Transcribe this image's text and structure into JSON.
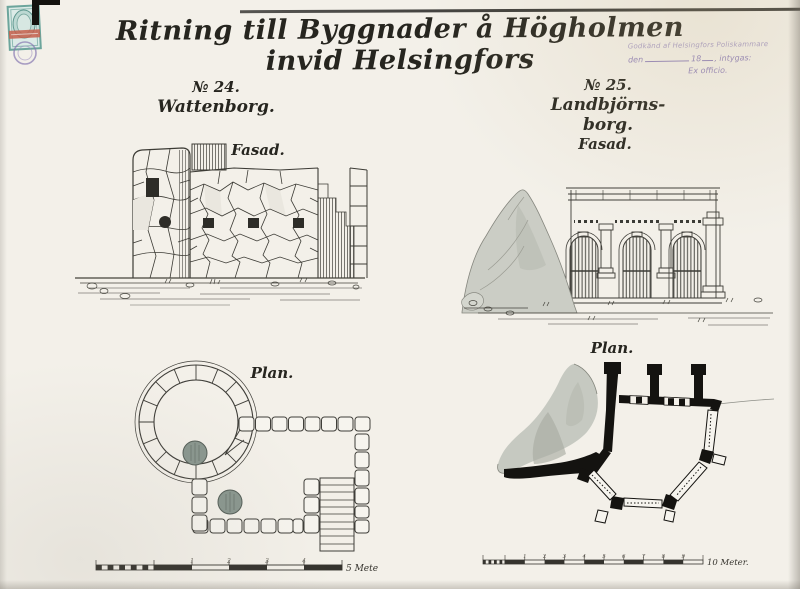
{
  "document": {
    "title": "Ritning till Byggnader å Högholmen invid Helsingfors",
    "approval_stamp": {
      "line1": "Godkänd af Helsingfors Poliskammare",
      "line2_den": "den",
      "line2_year": "18",
      "line2_intygas": ", intygas:",
      "line3": "Ex officio."
    },
    "left_section": {
      "number": "№ 24.",
      "name": "Wattenborg.",
      "fasad_label": "Fasad.",
      "plan_label": "Plan.",
      "scale": {
        "ticks": [
          "1",
          "2",
          "3",
          "4"
        ],
        "unit_label": "5 Meter."
      }
    },
    "right_section": {
      "number": "№ 25.",
      "name": "Landbjörns-borg.",
      "fasad_label": "Fasad.",
      "plan_label": "Plan.",
      "scale": {
        "ticks": [
          "1",
          "2",
          "3",
          "4",
          "5",
          "6",
          "7",
          "8",
          "9"
        ],
        "unit_label": "10 Meter."
      }
    }
  },
  "colors": {
    "paper": "#f3f0e9",
    "ink": "#26251f",
    "approval_purple": "#8b7cb8",
    "stamp_teal": "#6ca59c",
    "stamp_red": "#c75f4b",
    "rock_gray": "#c6c9c1",
    "plan_wall_black": "#141310"
  }
}
